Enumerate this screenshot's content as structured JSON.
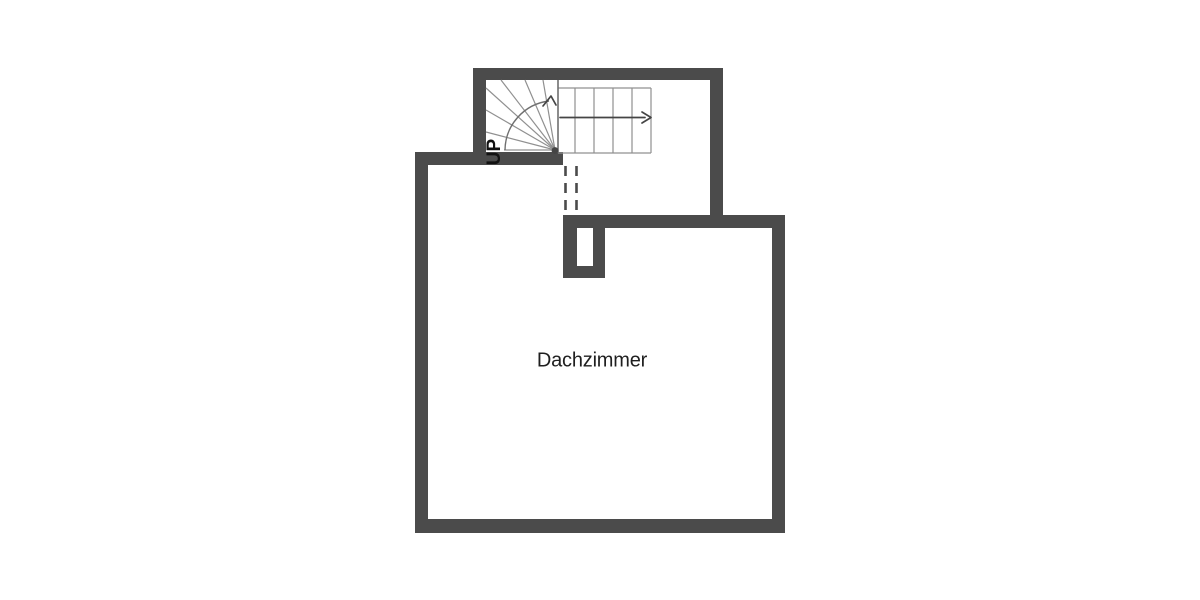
{
  "floorplan": {
    "rooms": [
      {
        "label": "Dachzimmer"
      }
    ],
    "stairs": {
      "direction_label": "UP",
      "straight_treads": 5,
      "winder_treads": 7,
      "description": "quarter-turn winder stair, up-direction shown by curved and straight arrows"
    },
    "features": [
      "chimney-shaft",
      "dashed-opening-under-stair"
    ]
  },
  "colors": {
    "background": "#ffffff",
    "wall": "#4b4b4b",
    "stair_line": "#909090",
    "stair_boundary": "#6f6f6f",
    "arrow": "#454545",
    "room_label": "#1f1f1f",
    "up_label": "#111111"
  }
}
